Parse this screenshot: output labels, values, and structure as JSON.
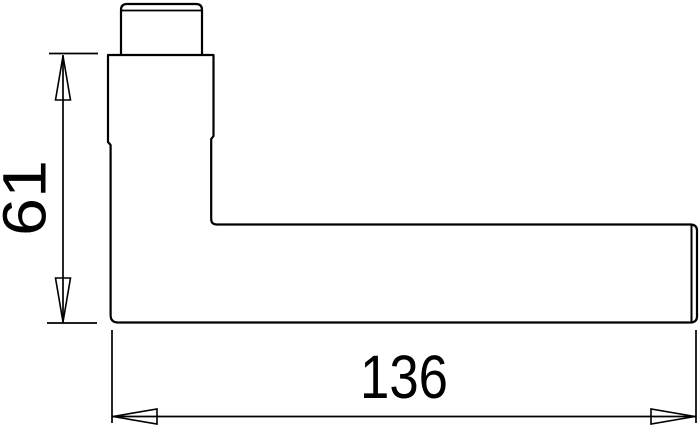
{
  "diagram": {
    "type": "technical-dimension-drawing",
    "subject": "door-lever-handle-side-profile",
    "background_color": "#ffffff",
    "line_color": "#000000",
    "dimensions": {
      "height_label": "61",
      "length_label": "136"
    }
  }
}
